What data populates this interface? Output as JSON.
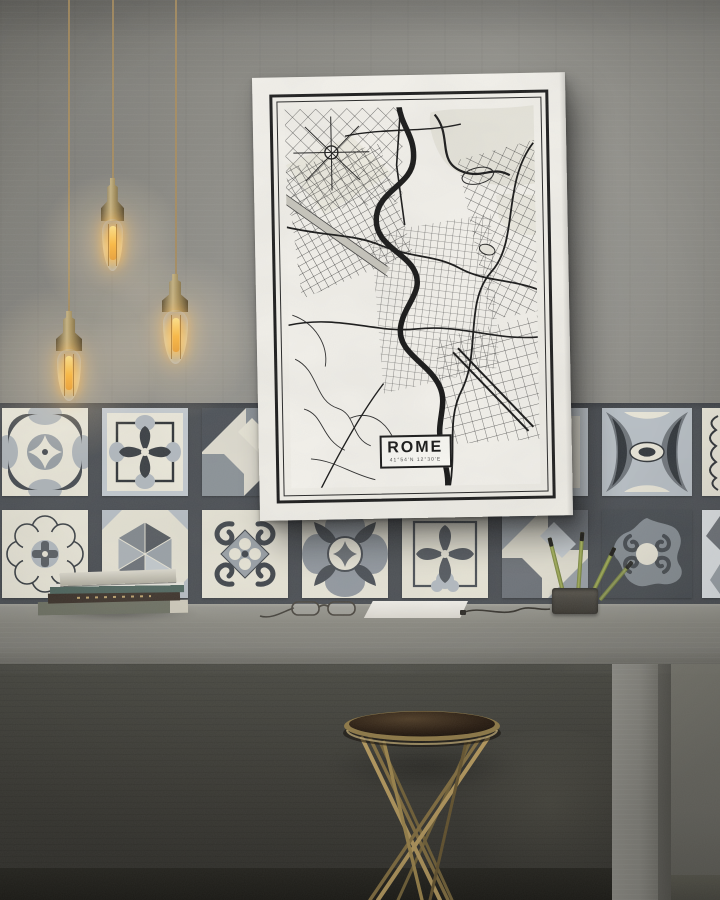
{
  "poster": {
    "title": "ROME",
    "coordinates": "41°54'N 12°30'E"
  },
  "colors": {
    "wall": "#8f8e88",
    "tile_grout": "#4a4e53",
    "tile_cream": "#e9e6d8",
    "tile_light_gray": "#b8bfc5",
    "tile_mid_gray": "#8b9197",
    "tile_charcoal": "#44494f",
    "brass": "#b3995f",
    "bulb_glow": "#ffc46a",
    "desk_concrete": "#85847d",
    "under_desk": "#3f3e38",
    "canvas_white": "#f4f2ec",
    "map_ink": "#1a1a1a",
    "stool_top_brown": "#2a1d12",
    "pencil_green": "#8a9848"
  }
}
